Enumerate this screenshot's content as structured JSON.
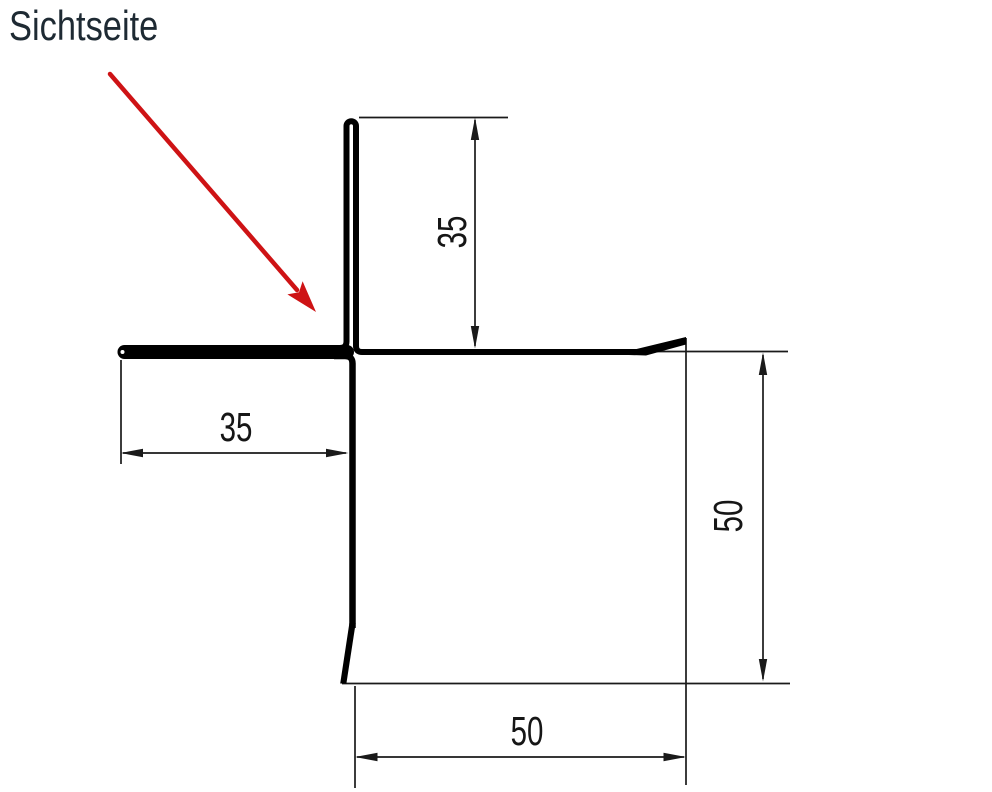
{
  "annotation": {
    "label": "Sichtseite",
    "arrow_color": "#ce1315",
    "label_color": "#1e2a33"
  },
  "profile": {
    "line_color": "#000000"
  },
  "dimensions": {
    "line_color": "#1a1a1a",
    "top_leg": {
      "value": "35",
      "orientation": "vertical"
    },
    "left_leg": {
      "value": "35",
      "orientation": "horizontal"
    },
    "right_height": {
      "value": "50",
      "orientation": "vertical"
    },
    "bottom_width": {
      "value": "50",
      "orientation": "horizontal"
    }
  }
}
